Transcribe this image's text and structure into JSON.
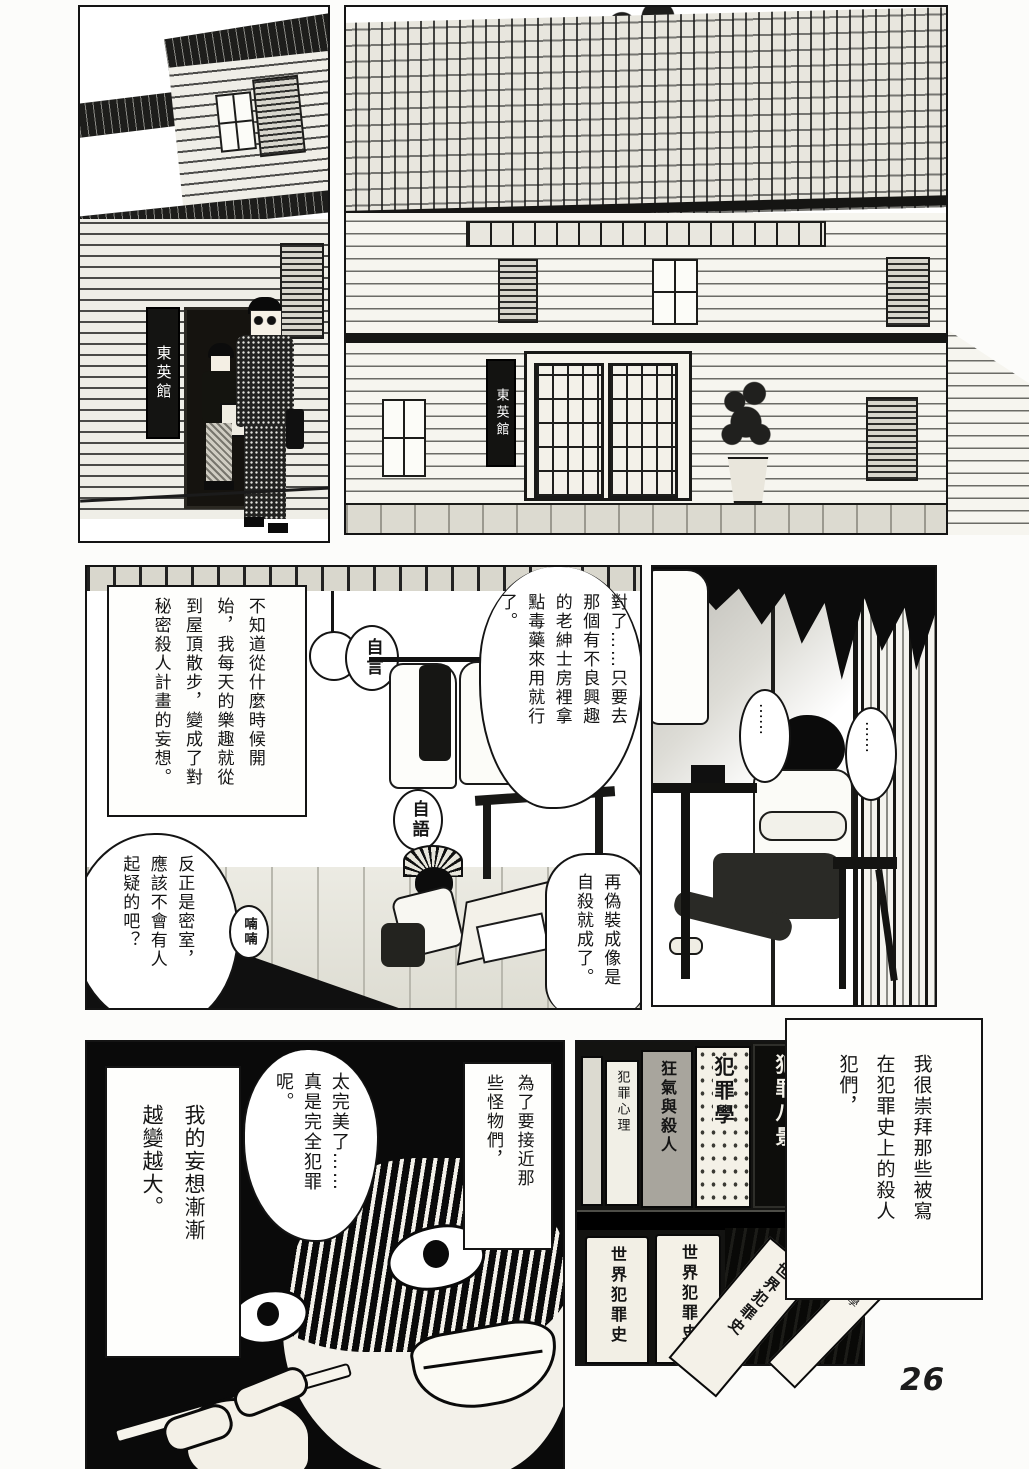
{
  "page_number": "26",
  "signs": {
    "inn_left": "東英館",
    "inn_right": "東英館"
  },
  "mid_left": {
    "narration": "不知道從什麼時候開始，我每天的樂趣就從到屋頂散步，變成了對秘密殺人計畫的妄想。",
    "bubble_poison": "對了……只要去那個有不良興趣的老紳士房裡拿點毒藥來用就行了。",
    "bubble_suicide": "再偽裝成像是自殺就成了。",
    "bubble_locked_room": "反正是密室，應該不會有人起疑的吧？",
    "label_self_talk_a": "自言",
    "label_self_talk_b": "自語",
    "label_mutter": "喃喃"
  },
  "mid_right": {
    "bubble_silence_a": "……",
    "bubble_silence_b": "……"
  },
  "bottom_left": {
    "narration_monsters": "為了要接近那些怪物們，",
    "bubble_perfect": "太完美了……真是完全犯罪呢。",
    "narration_delusion": "我的妄想漸漸越變越大。"
  },
  "bookshelf": {
    "top_row": [
      "犯罪八景",
      "犯罪學",
      "狂氣與殺人",
      "犯罪心理"
    ],
    "bottom_row": [
      "世界犯罪史",
      "世界犯罪史"
    ],
    "tilted": [
      "世界犯罪史",
      "科學"
    ]
  },
  "narration_admire": "我很崇拜那些被寫在犯罪史上的殺人犯們，"
}
